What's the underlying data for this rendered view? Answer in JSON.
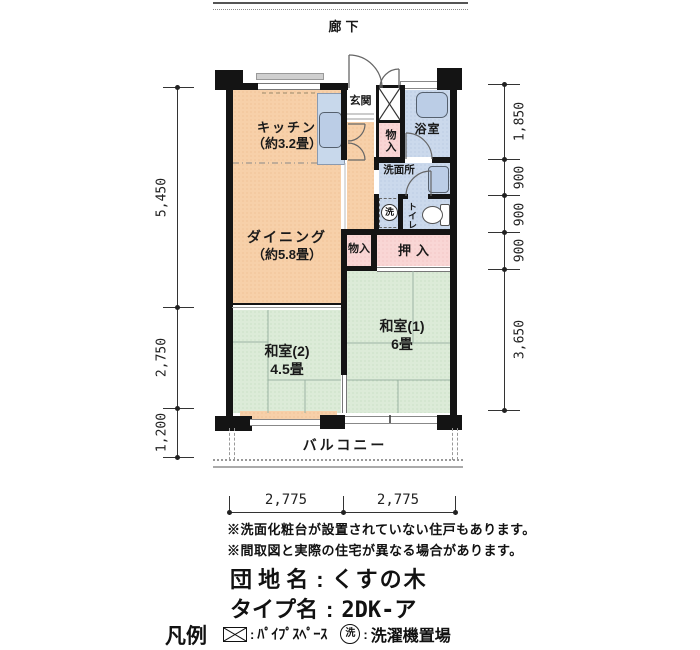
{
  "corridor": {
    "label": "廊下"
  },
  "plan": {
    "kitchen_name": "キッチン",
    "kitchen_size": "（約3.2畳）",
    "dining_name": "ダイニング",
    "dining_size": "（約5.8畳）",
    "genkan": "玄関",
    "bath": "浴室",
    "washroom": "洗面所",
    "toilet": "トイレ",
    "closet_upper": "物入",
    "closet_center": "物入",
    "oshiire": "押入",
    "washer_mark": "洗",
    "washitsu1_name": "和室(1)",
    "washitsu1_size": "6畳",
    "washitsu2_name": "和室(2)",
    "washitsu2_size": "4.5畳",
    "balcony": "バルコニー"
  },
  "dims": {
    "left": [
      "5,450",
      "2,750",
      "1,200"
    ],
    "right": [
      "1,850",
      "900",
      "900",
      "900",
      "3,650"
    ],
    "bottom": [
      "2,775",
      "2,775"
    ]
  },
  "notes": {
    "line1": "※洗面化粧台が設置されていない住戸もあります。",
    "line2": "※間取図と実際の住宅が異なる場合があります。"
  },
  "info": {
    "estate_label": "団 地 名",
    "estate_value": "くすの木",
    "type_label": "タイプ名",
    "type_value": "2DK-ア",
    "separator": ":"
  },
  "legend": {
    "title": "凡例",
    "colon": ":",
    "pipe_label": "ﾊﾟｲﾌﾟｽﾍﾟｰｽ",
    "washer_mark": "洗",
    "washer_label": "洗濯機置場"
  },
  "colors": {
    "wall": "#141414",
    "room_peach": "#F7D0A9",
    "room_green": "#DCEBD8",
    "room_blue": "#CBD9EC",
    "closet_pink": "#F9D6D5",
    "fixture_blue": "#BBCDE6"
  }
}
